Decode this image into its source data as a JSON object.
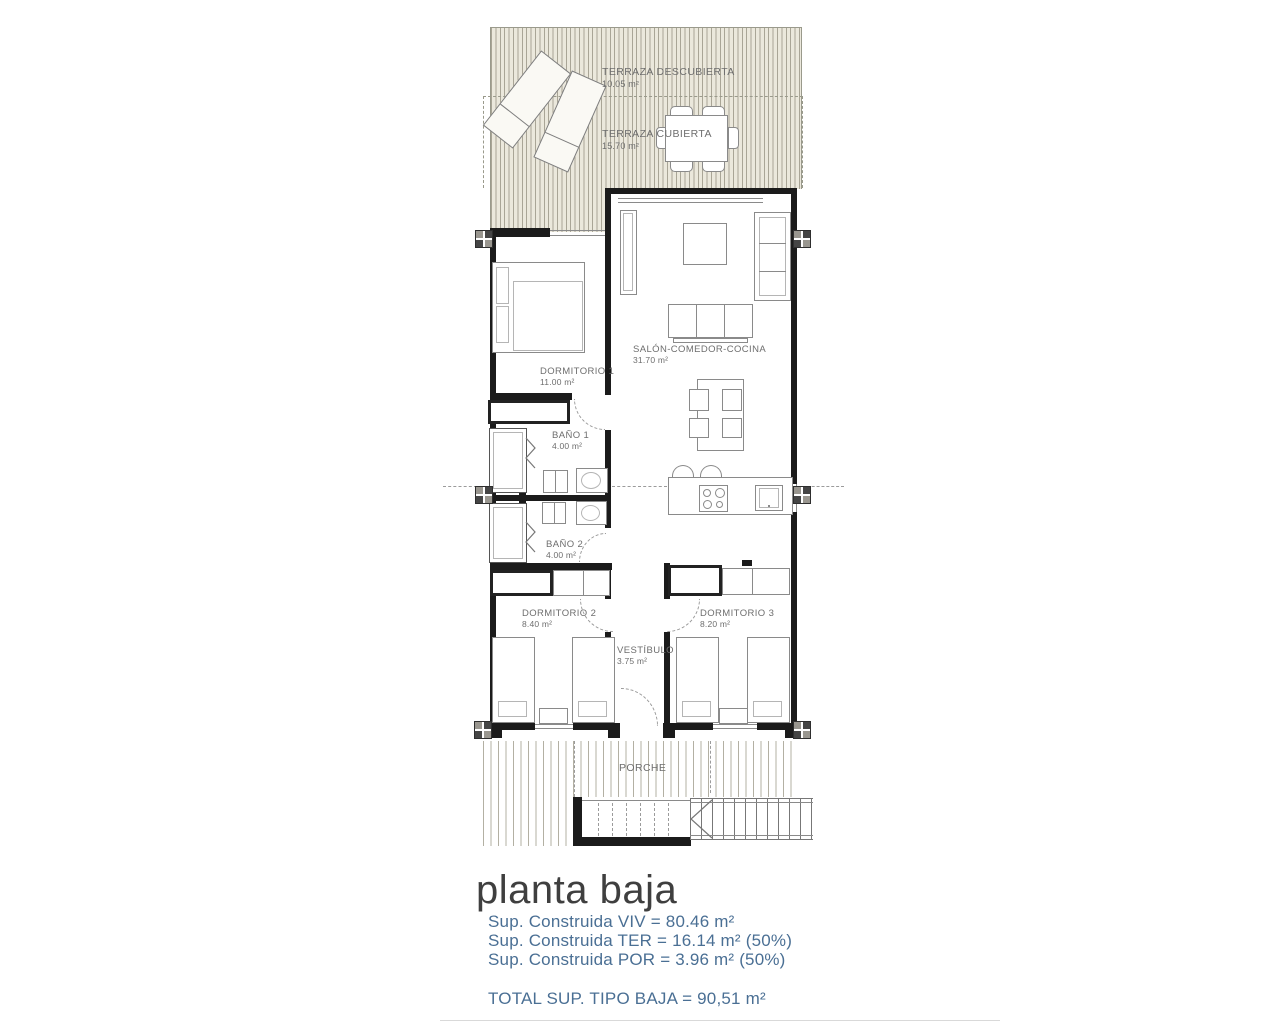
{
  "title": "planta baja",
  "colors": {
    "summary_text": "#4a6f94",
    "heading_text": "#3f3f3f",
    "wall": "#1b1b1b",
    "terrace_hatch_bg": "#ebe8dc"
  },
  "plan": {
    "rooms": {
      "terraza_descubierta": {
        "label": "TERRAZA DESCUBIERTA",
        "area": "10.05 m²"
      },
      "terraza_cubierta": {
        "label": "TERRAZA CUBIERTA",
        "area": "15.70 m²"
      },
      "salon": {
        "label": "SALÓN-COMEDOR-COCINA",
        "area": "31.70 m²"
      },
      "dormitorio1": {
        "label": "DORMITORIO 1",
        "area": "11.00 m²"
      },
      "bano1": {
        "label": "BAÑO 1",
        "area": "4.00 m²"
      },
      "bano2": {
        "label": "BAÑO 2",
        "area": "4.00 m²"
      },
      "dormitorio2": {
        "label": "DORMITORIO 2",
        "area": "8.40 m²"
      },
      "dormitorio3": {
        "label": "DORMITORIO 3",
        "area": "8.20 m²"
      },
      "vestibulo": {
        "label": "VESTÍBULO",
        "area": "3.75 m²"
      },
      "porche": {
        "label": "PORCHE"
      }
    }
  },
  "summary": {
    "line1": "Sup. Construida VIV = 80.46 m²",
    "line2": "Sup. Construida TER = 16.14 m² (50%)",
    "line3": "Sup. Construida POR = 3.96 m² (50%)",
    "total": "TOTAL SUP. TIPO BAJA = 90,51 m²"
  }
}
